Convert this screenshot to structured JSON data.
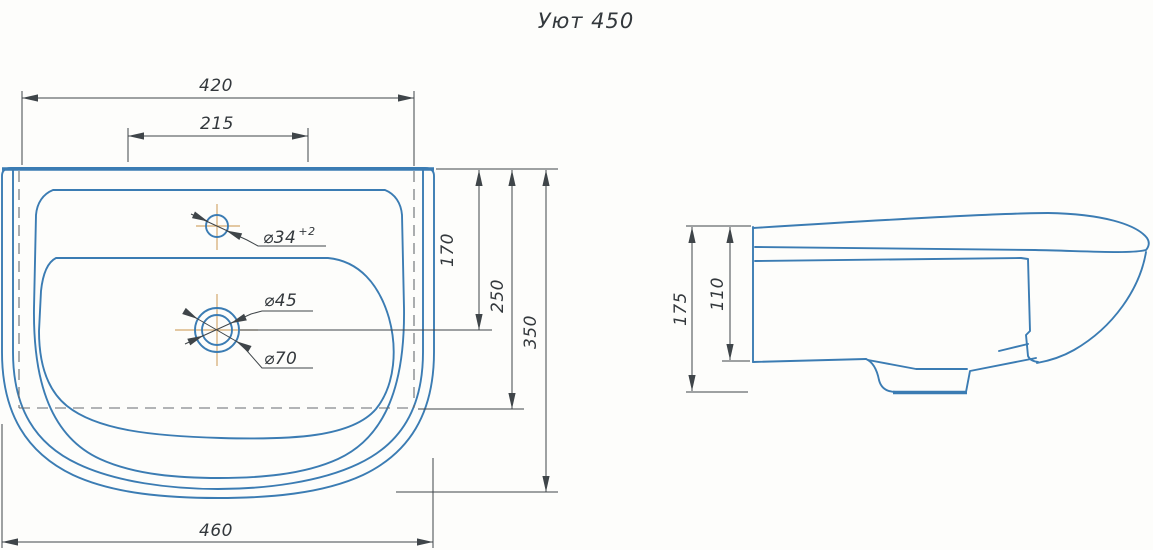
{
  "title": "Уют 450",
  "colors": {
    "line": "#3b7cb3",
    "line_fill": "#d9ecf8",
    "dim": "#3f4549",
    "centerline": "#d4a96e",
    "dashcolor": "#666c71",
    "text": "#33383c",
    "background": "#fdfdfb"
  },
  "plan": {
    "dim_420": "420",
    "dim_215": "215",
    "dim_460": "460",
    "dim_170": "170",
    "dim_250": "250",
    "dim_350": "350",
    "faucet_label": "⌀34",
    "faucet_tol": "+2",
    "drain_inner_label": "⌀45",
    "drain_outer_label": "⌀70"
  },
  "side": {
    "dim_175": "175",
    "dim_110": "110"
  }
}
